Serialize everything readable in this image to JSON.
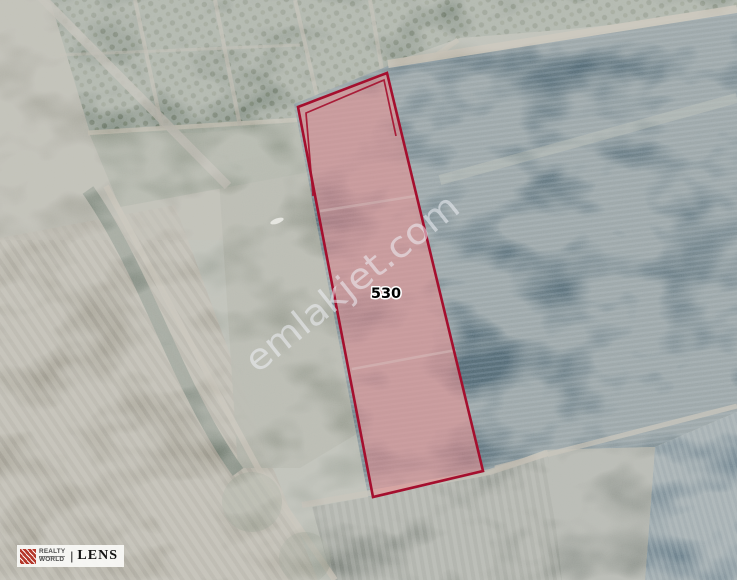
{
  "map": {
    "description": "Satellite view of farmland with highlighted land parcel",
    "parcel": {
      "number": "530",
      "outline_color": "#a50f2e",
      "fill_color": "#e59192"
    },
    "watermark": {
      "text": "emlakjet.com",
      "color": "#eef1f6"
    }
  },
  "logo": {
    "realty": "REALTY",
    "world": "WORLD",
    "divider": "|",
    "lens": "LENS",
    "icon": "realty-world-fan-icon",
    "icon_color": "#b5372a"
  }
}
